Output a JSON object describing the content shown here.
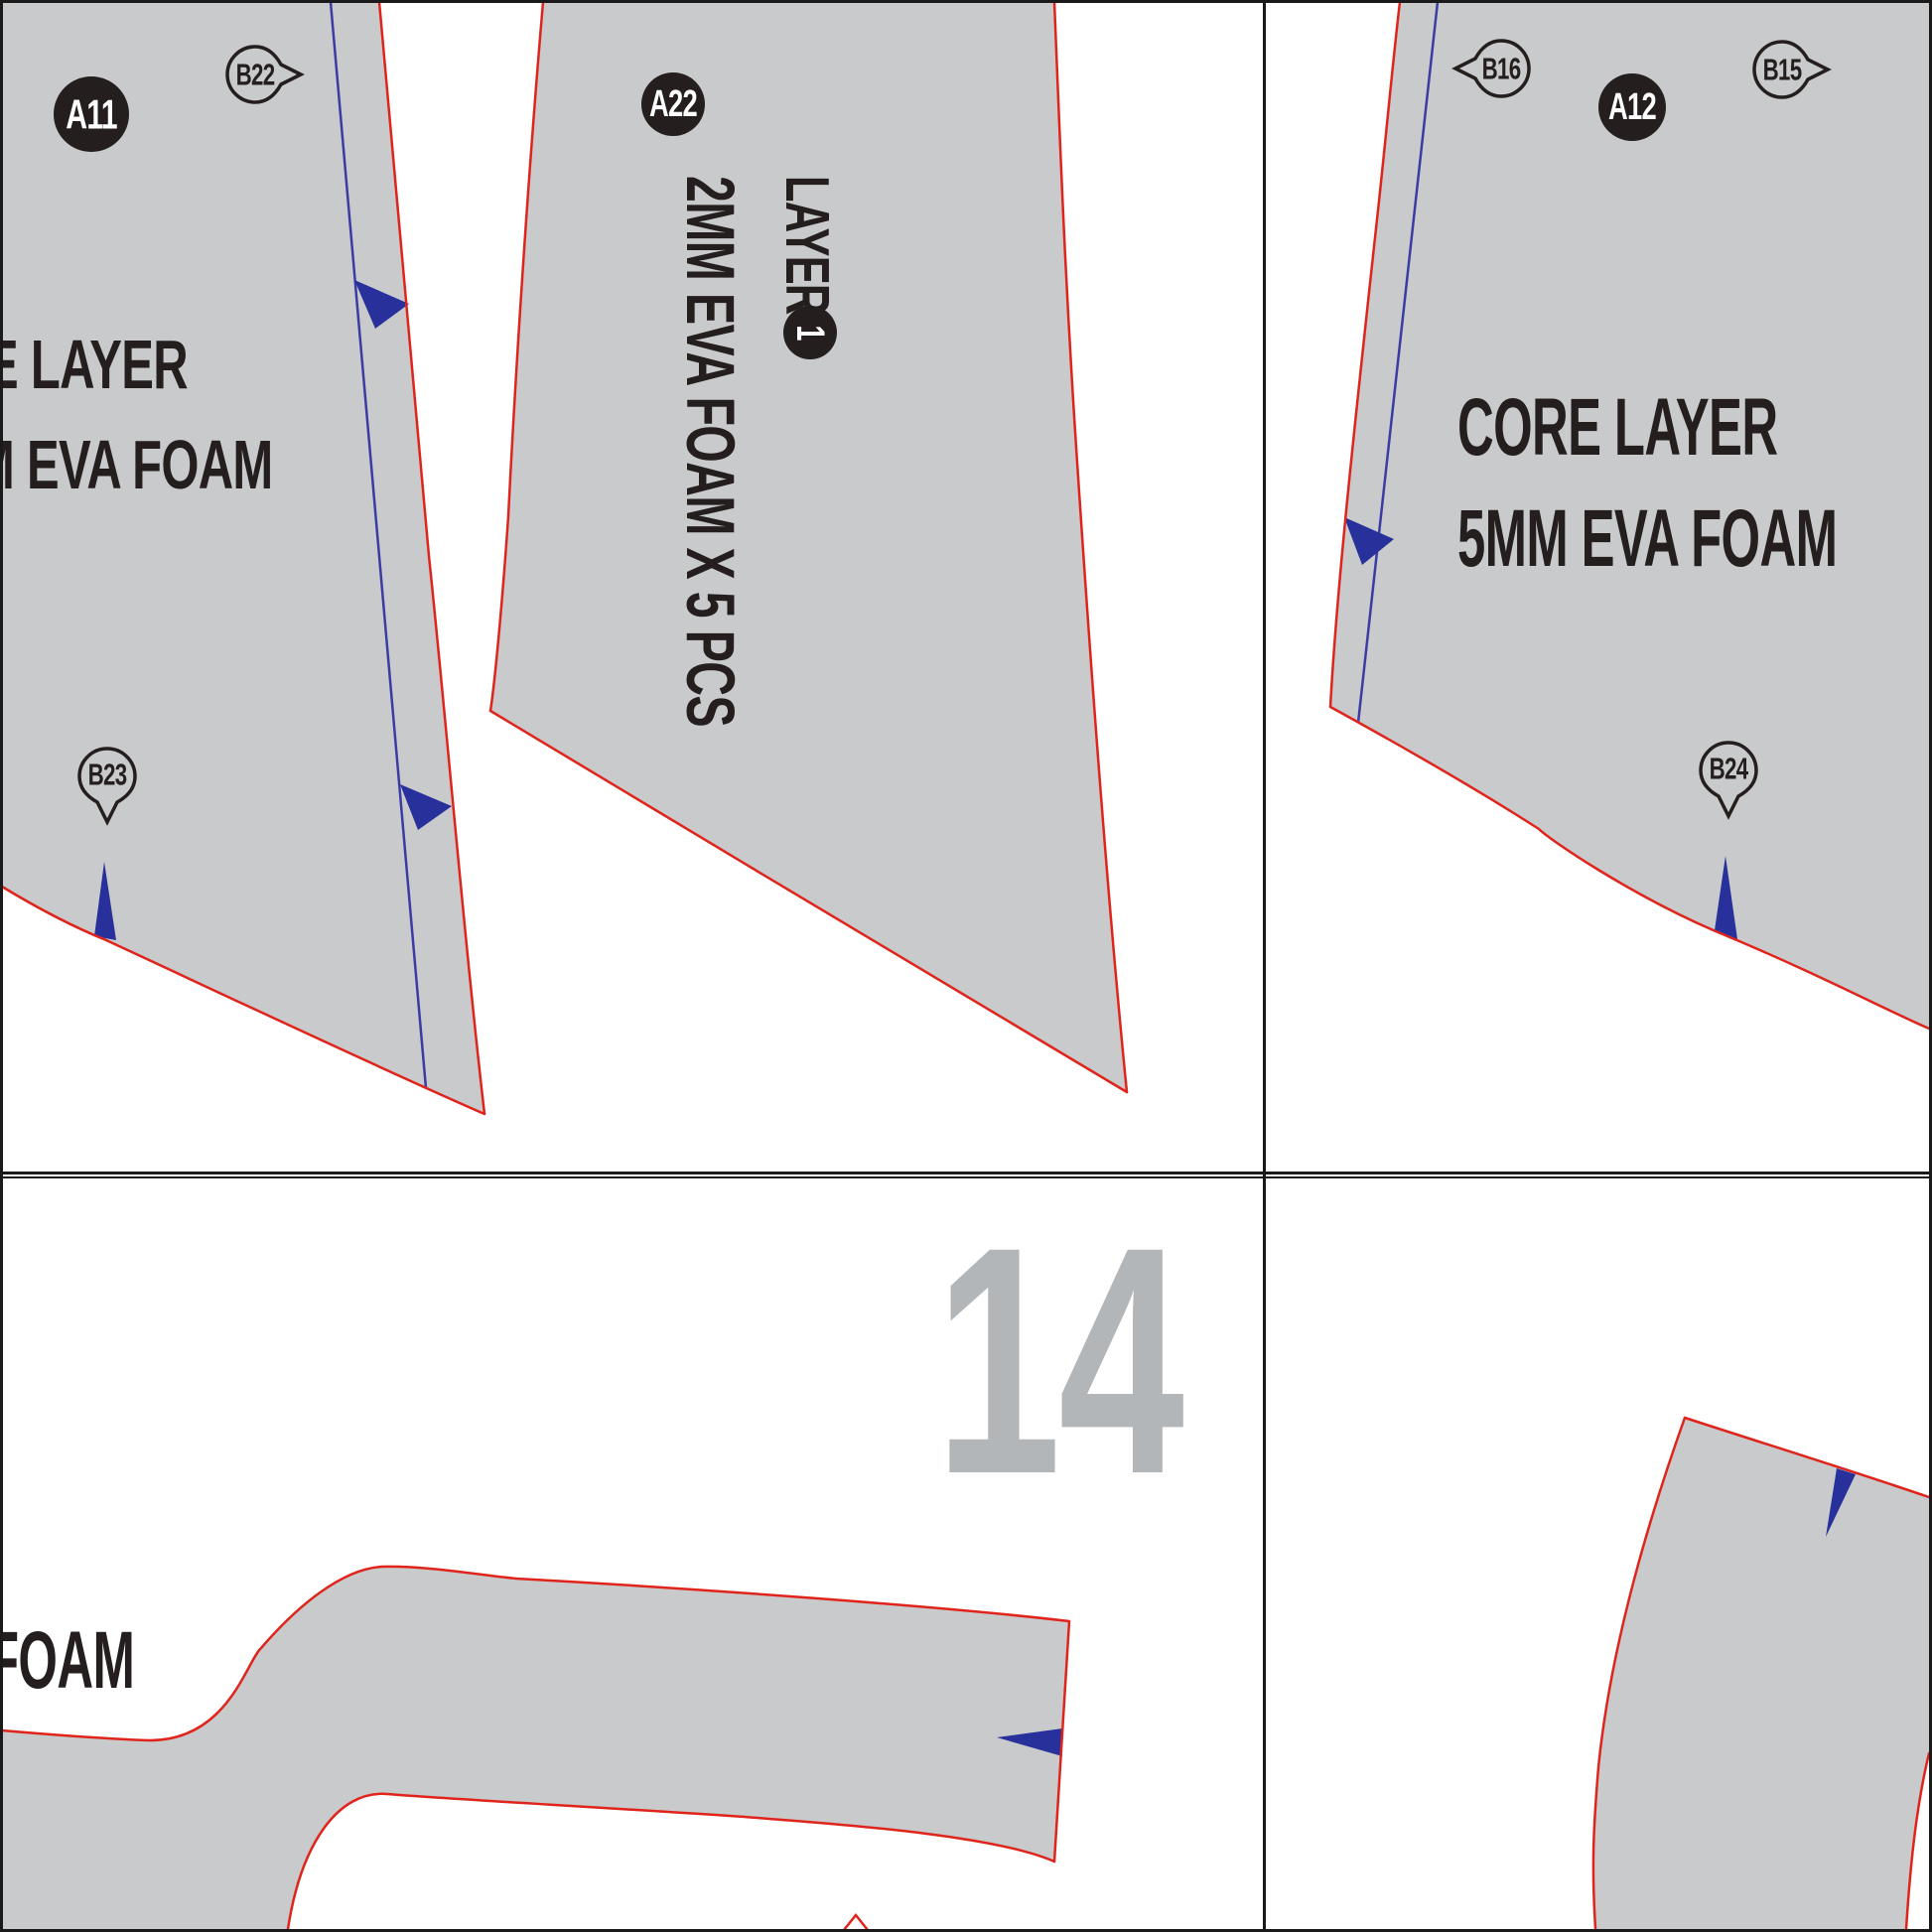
{
  "colors": {
    "piece_fill": "#c9cacb",
    "cut_red": "#e0241b",
    "guide_blue": "#3b3ba6",
    "notch_navy": "#28309b",
    "ink": "#241f1e",
    "label_white": "#ffffff",
    "page_num_gray": "#b3b6b8",
    "border_black": "#1a1a1a",
    "paper": "#ffffff"
  },
  "markers": {
    "a11": "A11",
    "a22": "A22",
    "a12": "A12",
    "b22": "B22",
    "b23": "B23",
    "b16": "B16",
    "b15": "B15",
    "b24": "B24",
    "a22_layer_number": "1"
  },
  "texts": {
    "a11_line1": "E LAYER",
    "a11_line2": "M EVA FOAM",
    "a22_layer": "LAYER",
    "a22_material": "2MM EVA FOAM X 5 PCS",
    "a12_line1": "CORE LAYER",
    "a12_line2": "5MM EVA FOAM",
    "strip_fragment": "FOAM",
    "page_number": "14"
  }
}
